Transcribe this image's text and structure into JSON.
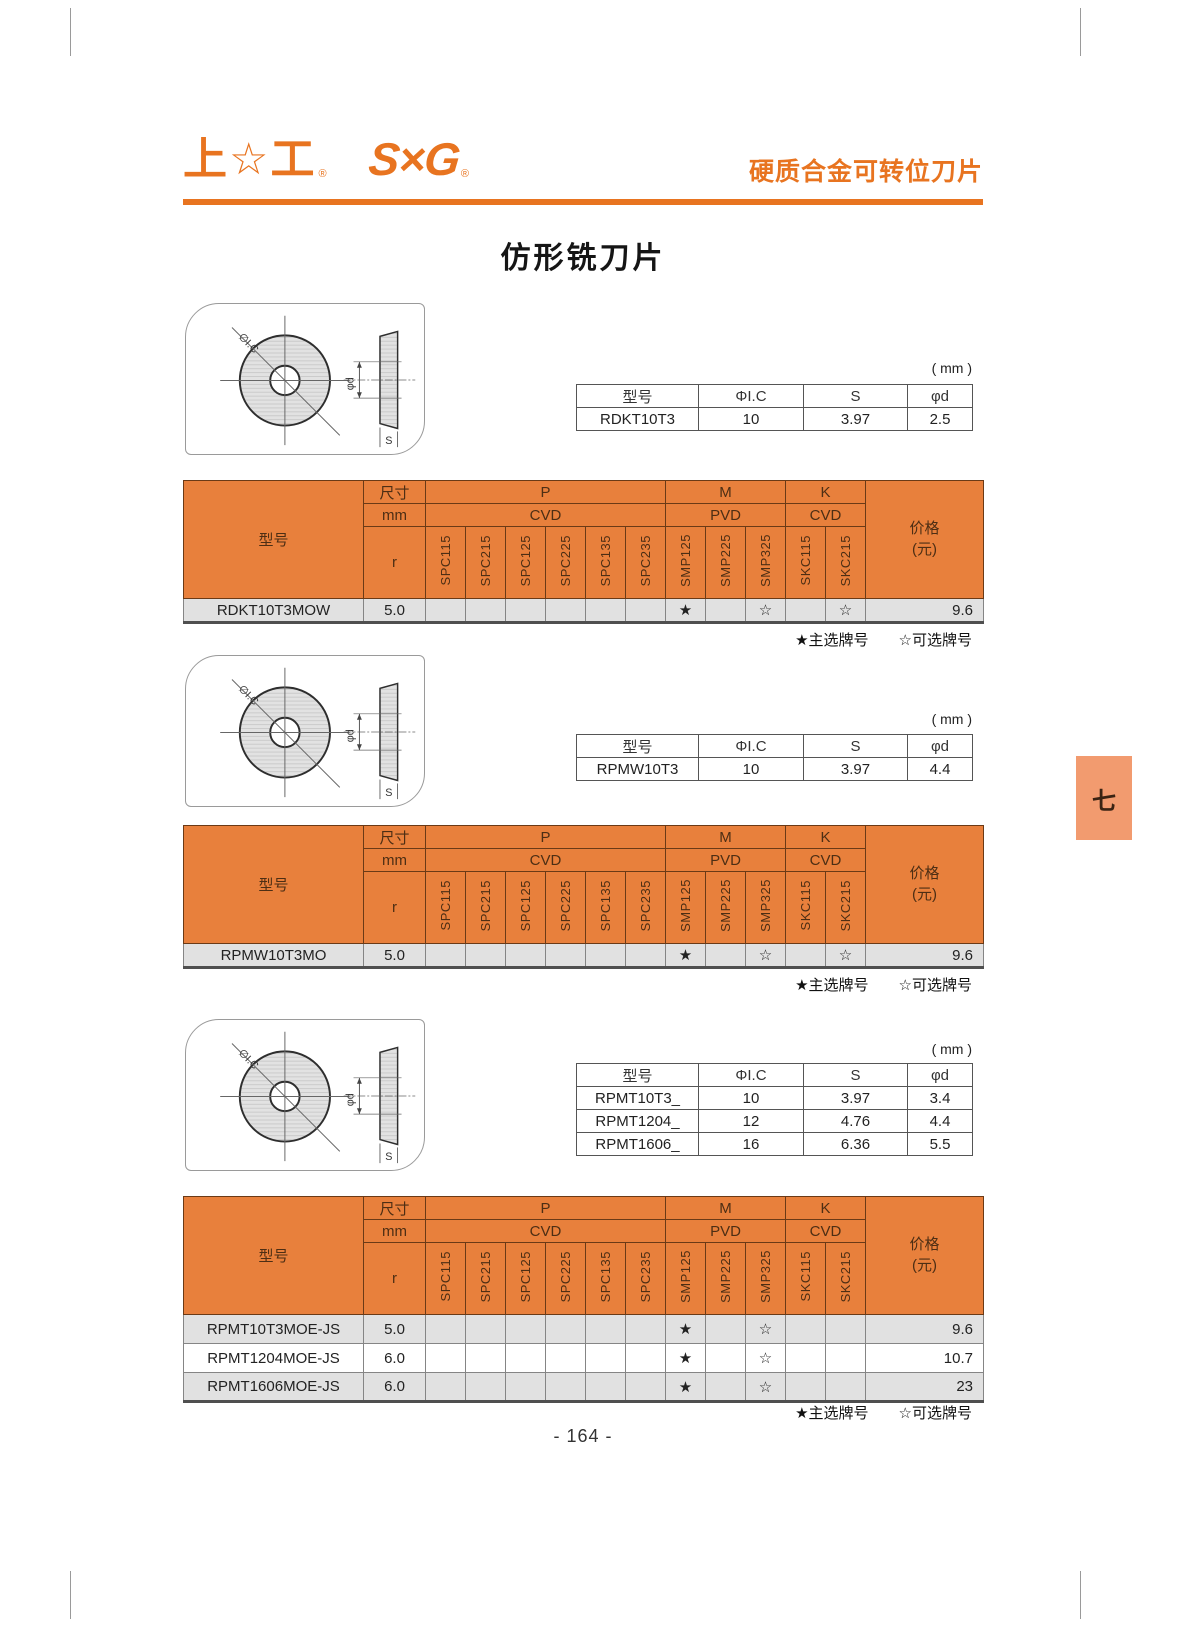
{
  "colors": {
    "brand": "#E87420",
    "table-orange": "#E8803C",
    "tab-orange": "#F29B6F",
    "row-gray": "#E1E1E1",
    "hdr-text": "#4D2E14",
    "hdr-line": "#6B3A16",
    "data-line": "#858585",
    "text": "#1F1F1F"
  },
  "header": {
    "logo_sx": "上☆工",
    "logo_reg": "®",
    "logo_sg": "S×G",
    "title": "硬质合金可转位刀片"
  },
  "page": {
    "title": "仿形铣刀片",
    "unit": "( mm )",
    "number": "- 164 -",
    "side_tab": "七"
  },
  "legend": {
    "primary": "★主选牌号",
    "optional": "☆可选牌号"
  },
  "drawing": {
    "ic": "∅I.C",
    "d": "φd",
    "s": "S"
  },
  "spec_header": {
    "model": "型号",
    "ic": "ΦI.C",
    "s": "S",
    "d": "φd"
  },
  "grade_header": {
    "model": "型号",
    "size": "尺寸",
    "mm": "mm",
    "r": "r",
    "p": "P",
    "m": "M",
    "k": "K",
    "cvd": "CVD",
    "pvd": "PVD",
    "cvd2": "CVD",
    "price": "价格",
    "yuan": "(元)",
    "grades": [
      "SPC115",
      "SPC215",
      "SPC125",
      "SPC225",
      "SPC135",
      "SPC235",
      "SMP125",
      "SMP225",
      "SMP325",
      "SKC115",
      "SKC215"
    ]
  },
  "sections": [
    {
      "spec_rows": [
        [
          "RDKT10T3",
          "10",
          "3.97",
          "2.5"
        ]
      ],
      "rows": [
        {
          "model": "RDKT10T3MOW",
          "r": "5.0",
          "marks": [
            "",
            "",
            "",
            "",
            "",
            "",
            "★",
            "",
            "☆",
            "",
            "☆"
          ],
          "price": "9.6"
        }
      ]
    },
    {
      "spec_rows": [
        [
          "RPMW10T3",
          "10",
          "3.97",
          "4.4"
        ]
      ],
      "rows": [
        {
          "model": "RPMW10T3MO",
          "r": "5.0",
          "marks": [
            "",
            "",
            "",
            "",
            "",
            "",
            "★",
            "",
            "☆",
            "",
            "☆"
          ],
          "price": "9.6"
        }
      ]
    },
    {
      "spec_rows": [
        [
          "RPMT10T3_",
          "10",
          "3.97",
          "3.4"
        ],
        [
          "RPMT1204_",
          "12",
          "4.76",
          "4.4"
        ],
        [
          "RPMT1606_",
          "16",
          "6.36",
          "5.5"
        ]
      ],
      "rows": [
        {
          "model": "RPMT10T3MOE-JS",
          "r": "5.0",
          "marks": [
            "",
            "",
            "",
            "",
            "",
            "",
            "★",
            "",
            "☆",
            "",
            ""
          ],
          "price": "9.6"
        },
        {
          "model": "RPMT1204MOE-JS",
          "r": "6.0",
          "marks": [
            "",
            "",
            "",
            "",
            "",
            "",
            "★",
            "",
            "☆",
            "",
            ""
          ],
          "price": "10.7"
        },
        {
          "model": "RPMT1606MOE-JS",
          "r": "6.0",
          "marks": [
            "",
            "",
            "",
            "",
            "",
            "",
            "★",
            "",
            "☆",
            "",
            ""
          ],
          "price": "23"
        }
      ]
    }
  ]
}
